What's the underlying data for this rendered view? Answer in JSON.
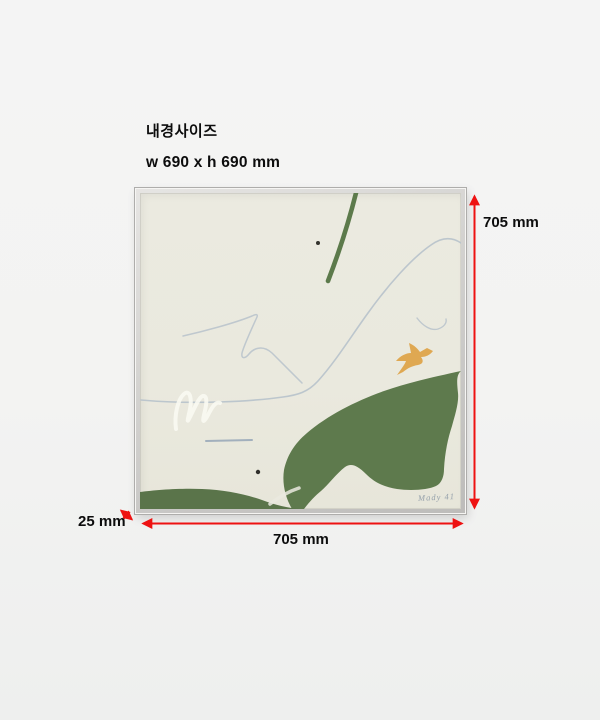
{
  "annotation": {
    "title": "내경사이즈",
    "inner_size": "w 690 x h 690 mm",
    "height_label": "705 mm",
    "width_label": "705 mm",
    "depth_label": "25 mm",
    "arrow_color": "#ee1212"
  },
  "artwork": {
    "signature": "Mady 41",
    "frame_color": "#c9c8c6",
    "canvas_color": "#eae9df",
    "green_main": "#5e7a4d",
    "green_strip": "#5a744a",
    "green_stroke": "#5c7a4b",
    "bird_color": "#dfa852",
    "curve_color": "#b7c2cb",
    "squiggle_color": "#f8f8f1"
  }
}
